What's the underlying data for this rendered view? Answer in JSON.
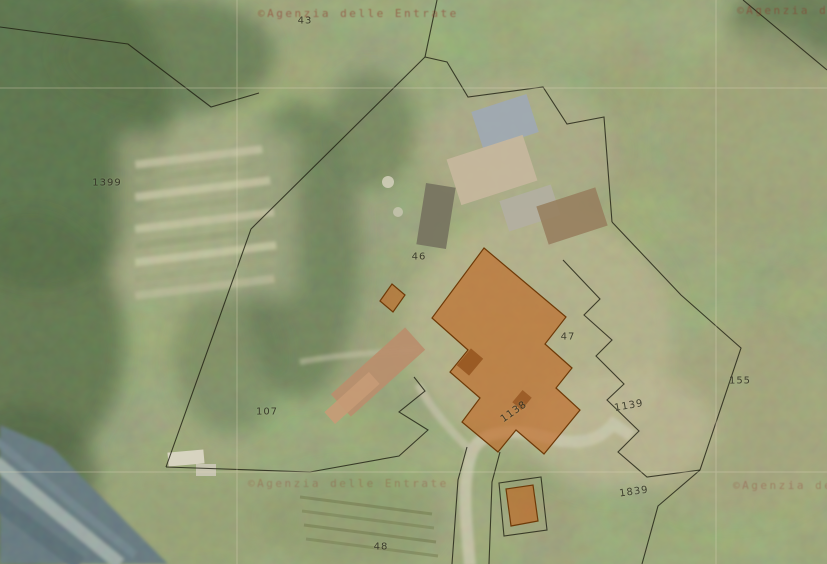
{
  "map": {
    "description": "Cadastral parcel overlay on aerial photography",
    "watermark_text": "©Agenzia delle Entrate",
    "colors": {
      "parcel_highlight": "#c1641e",
      "parcel_highlight_stroke": "#6e3a08",
      "boundary_line": "#1f1f14",
      "watermark_red": "#8e3226",
      "grid_line": "#e0d8bc",
      "road": "#d6cfba",
      "water_band": "#5e7286"
    },
    "parcel_labels": [
      {
        "id": "43",
        "x": 305,
        "y": 21,
        "rotate": 0
      },
      {
        "id": "1399",
        "x": 107,
        "y": 183,
        "rotate": 0
      },
      {
        "id": "46",
        "x": 419,
        "y": 257,
        "rotate": 0
      },
      {
        "id": "47",
        "x": 568,
        "y": 337,
        "rotate": 0
      },
      {
        "id": "155",
        "x": 740,
        "y": 381,
        "rotate": 0
      },
      {
        "id": "107",
        "x": 267,
        "y": 412,
        "rotate": 0
      },
      {
        "id": "1138",
        "x": 514,
        "y": 412,
        "rotate": -35
      },
      {
        "id": "1139",
        "x": 629,
        "y": 406,
        "rotate": -10
      },
      {
        "id": "1839",
        "x": 634,
        "y": 492,
        "rotate": -8
      },
      {
        "id": "48",
        "x": 381,
        "y": 547,
        "rotate": 0
      }
    ],
    "watermarks": [
      {
        "text": "©Agenzia delle Entrate",
        "x": 258,
        "y": 7,
        "opacity": 0.55
      },
      {
        "text": "©Agenzia delle Entrate",
        "x": 737,
        "y": 4,
        "opacity": 0.5
      },
      {
        "text": "©Agenzia delle Entrate",
        "x": 248,
        "y": 477,
        "opacity": 0.3
      },
      {
        "text": "©Agenzia delle Entrate",
        "x": 733,
        "y": 479,
        "opacity": 0.33
      }
    ],
    "highlighted_features": [
      "main-farm-building",
      "small-annex-northwest",
      "small-annex-south"
    ]
  }
}
